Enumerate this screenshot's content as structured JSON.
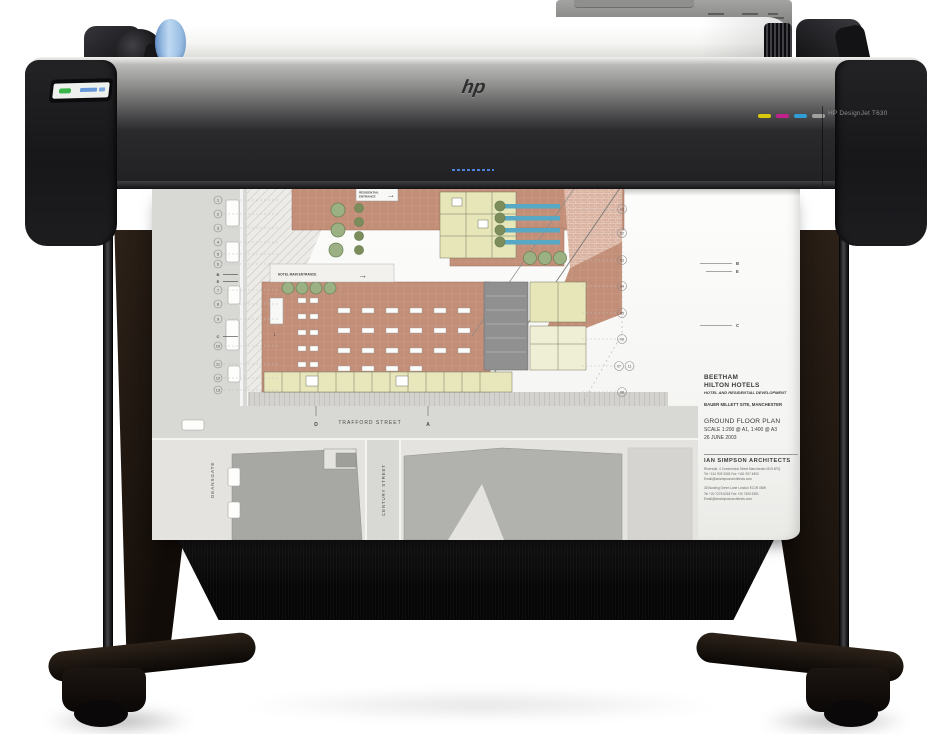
{
  "product": {
    "brand_logo": "hp",
    "model_label": "HP DesignJet T630"
  },
  "printer": {
    "control_panel_power_color": "#3ab54a",
    "control_panel_accent_color": "#4d88d4",
    "ink_marks": {
      "yellow": "#d6c80a",
      "magenta": "#c0218c",
      "cyan": "#2f9ed6",
      "gray": "#a0a09e"
    },
    "roll_hub_color": "#a9c9ea"
  },
  "icons": {
    "arrow_right": "→",
    "arrow_down": "↓"
  },
  "sheet": {
    "title_block": {
      "project": "BEETHAM",
      "client": "HILTON HOTELS",
      "subtitle": "HOTEL AND RESIDENTIAL DEVELOPMENT",
      "site": "BAUER MILLETT SITE, MANCHESTER",
      "drawing": "GROUND FLOOR PLAN",
      "scale": "SCALE  1:200 @ A1, 1:400 @ A3",
      "date": "26 JUNE 2003",
      "firm": "IAN SIMPSON ARCHITECTS",
      "address1": "Riverside, 4 Commercial Street  Manchester  M15 4RQ",
      "phone1": "Tel +161 905 3345   Fax +161 907 4800",
      "email1": "Email@iansimpsonarchitects.com",
      "address2": "36 Bowling Green Lane  London  EC1R 0BW",
      "phone2": "Tel +20 7278 6318   Fax +20 7490 5351",
      "email2": "Email@iansimpsonarchitects.com"
    },
    "streets": {
      "horizontal": "TRAFFORD STREET",
      "left_vertical": "DEANSGATE",
      "right_vertical": "CENTURY STREET"
    },
    "signs": {
      "residential_line1": "RESIDENTIAL",
      "residential_line2": "ENTRANCE",
      "hotel_main": "HOTEL MAIN ENTRANCE"
    },
    "grid": {
      "left": [
        "1",
        "2",
        "3",
        "4",
        "5",
        "6",
        "7",
        "8",
        "9",
        "10",
        "11",
        "12",
        "13"
      ],
      "left_letters": [
        "B",
        "E",
        "C"
      ],
      "right": [
        "01",
        "02",
        "03",
        "04",
        "05",
        "06",
        "07",
        "08"
      ],
      "right_extra": "11",
      "edge_letters": [
        "B",
        "E",
        "C"
      ],
      "road_letters": [
        "D",
        "A"
      ]
    },
    "plan_colors": {
      "terracotta": "#c28e78",
      "rooms_yellow": "#e6e6b8",
      "trees_green": "#9cb183",
      "water_teal": "#57a8c4",
      "street_gray": "#d8d8d5",
      "building_gray": "#a7a7a4",
      "core_gray": "#909090"
    }
  }
}
